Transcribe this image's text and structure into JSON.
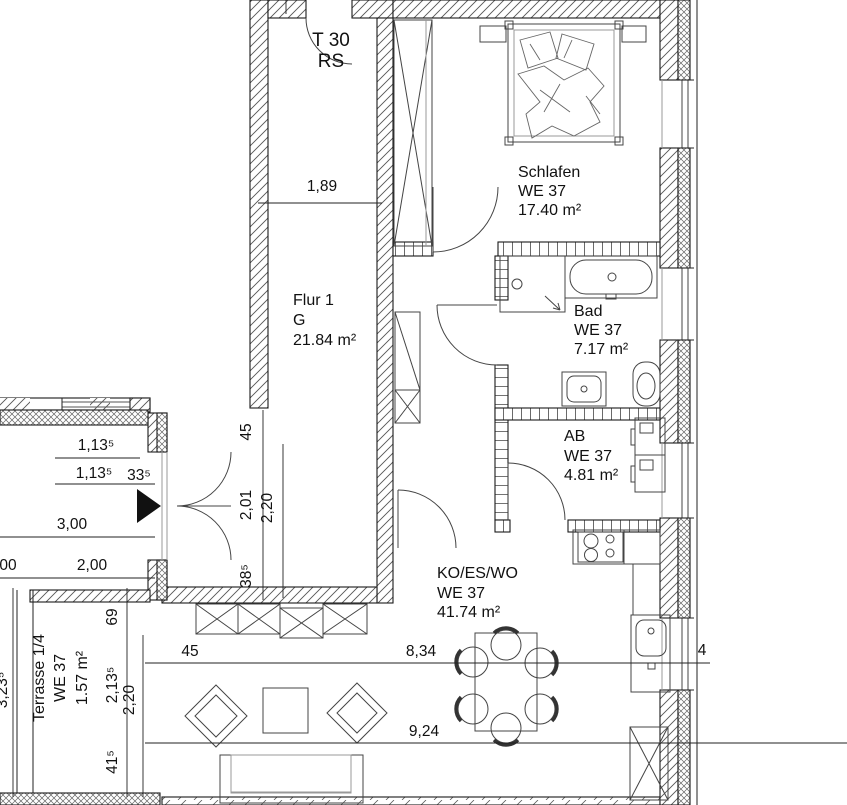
{
  "plan": {
    "door_top": {
      "line1": "T 30",
      "line2": "RS"
    },
    "rooms": {
      "flur": {
        "name": "Flur 1",
        "code": "G",
        "area": "21.84 m²"
      },
      "schlafen": {
        "name": "Schlafen",
        "unit": "WE 37",
        "area": "17.40 m²"
      },
      "bad": {
        "name": "Bad",
        "unit": "WE 37",
        "area": "7.17 m²"
      },
      "ab": {
        "name": "AB",
        "unit": "WE 37",
        "area": "4.81 m²"
      },
      "wohnen": {
        "name": "KO/ES/WO",
        "unit": "WE 37",
        "area": "41.74 m²"
      },
      "terrasse": {
        "name": "Terrasse 1/4",
        "unit": "WE 37",
        "area": "1.57 m²"
      }
    },
    "dims": {
      "flur_width": "1,89",
      "entry_45": "45",
      "entry_201": "2,01",
      "entry_220": "2,20",
      "entry_385": "38⁵",
      "win1": "1,13⁵",
      "win2": "1,13⁵",
      "win3": "33⁵",
      "w300": "3,00",
      "cut00": "00",
      "w200": "2,00",
      "terr_total": "3,23⁵",
      "terr_69": "69",
      "terr_2135": "2,13⁵",
      "terr_220": "2,20",
      "terr_415": "41⁵",
      "wall_45": "45",
      "w834": "8,34",
      "w924": "9,24",
      "wall_4": "4"
    }
  }
}
